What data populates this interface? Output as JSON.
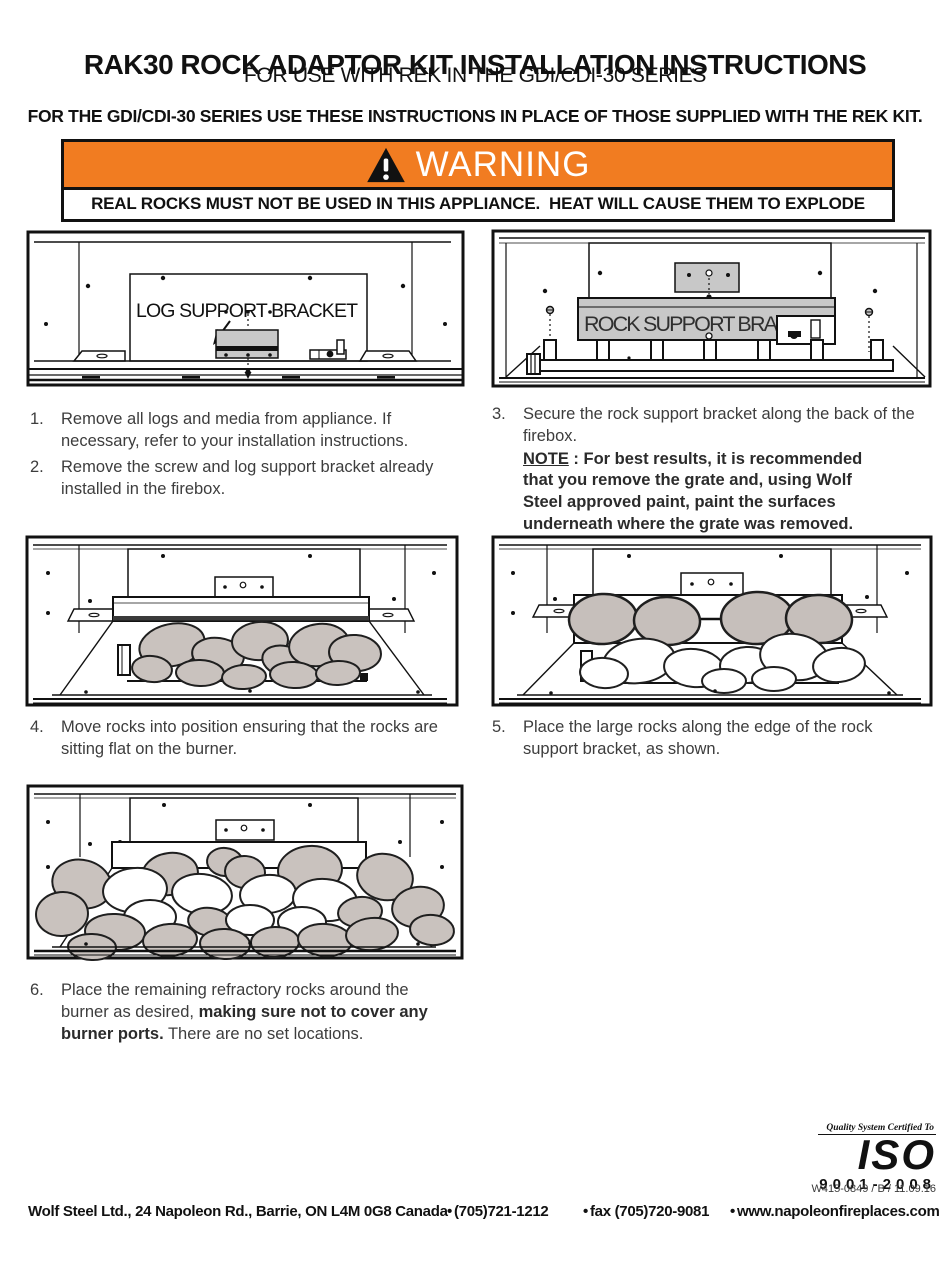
{
  "header": {
    "title": "RAK30 ROCK ADAPTOR KIT INSTALLATION INSTRUCTIONS",
    "subtitle": "FOR USE WITH REK IN THE GDI/CDI-30 SERIES",
    "directive": "FOR THE GDI/CDI-30 SERIES USE THESE INSTRUCTIONS IN PLACE OF THOSE SUPPLIED WITH THE REK KIT."
  },
  "warning": {
    "label": "WARNING",
    "banner_color": "#f17c21",
    "message": "REAL ROCKS MUST NOT BE USED IN THIS APPLIANCE.  HEAT WILL CAUSE THEM TO EXPLODE"
  },
  "figures": {
    "log_bracket_label": "LOG SUPPORT BRACKET",
    "rock_bracket_label": "ROCK SUPPORT BRACKET",
    "rock_color": "#c9c2be",
    "bracket_color": "#c8c8c8"
  },
  "steps": [
    {
      "num": "1.",
      "text": "Remove all logs and media from appliance. If necessary, refer to your installation instructions."
    },
    {
      "num": "2.",
      "text": "Remove the screw and log support bracket already installed in the firebox."
    },
    {
      "num": "3.",
      "text": "Secure the rock support bracket along the back of the firebox.",
      "note_label": "NOTE",
      "note_text": " : For best results, it is recommended that you remove the grate and, using Wolf Steel approved paint, paint the surfaces underneath where the grate was removed."
    },
    {
      "num": "4.",
      "text": "Move rocks into position ensuring that the rocks are sitting flat on the burner."
    },
    {
      "num": "5.",
      "text": "Place the large rocks along the edge of the rock support bracket, as shown."
    },
    {
      "num": "6.",
      "text": "Place the remaining refractory rocks around the burner as desired, ",
      "text_bold": "making sure not to cover any burner ports.",
      "text_end": " There are no set locations."
    }
  ],
  "certification": {
    "tagline": "Quality System Certified To",
    "name": "ISO",
    "standard": "9001-2008",
    "document_code": "W415-0849 / B / 11.09.16"
  },
  "footer": {
    "bullet": "•",
    "company": "Wolf Steel Ltd., 24 Napoleon Rd., Barrie, ON L4M 0G8 Canada",
    "phone": "(705)721-1212",
    "fax": "fax (705)720-9081",
    "website": "www.napoleonfireplaces.com"
  }
}
